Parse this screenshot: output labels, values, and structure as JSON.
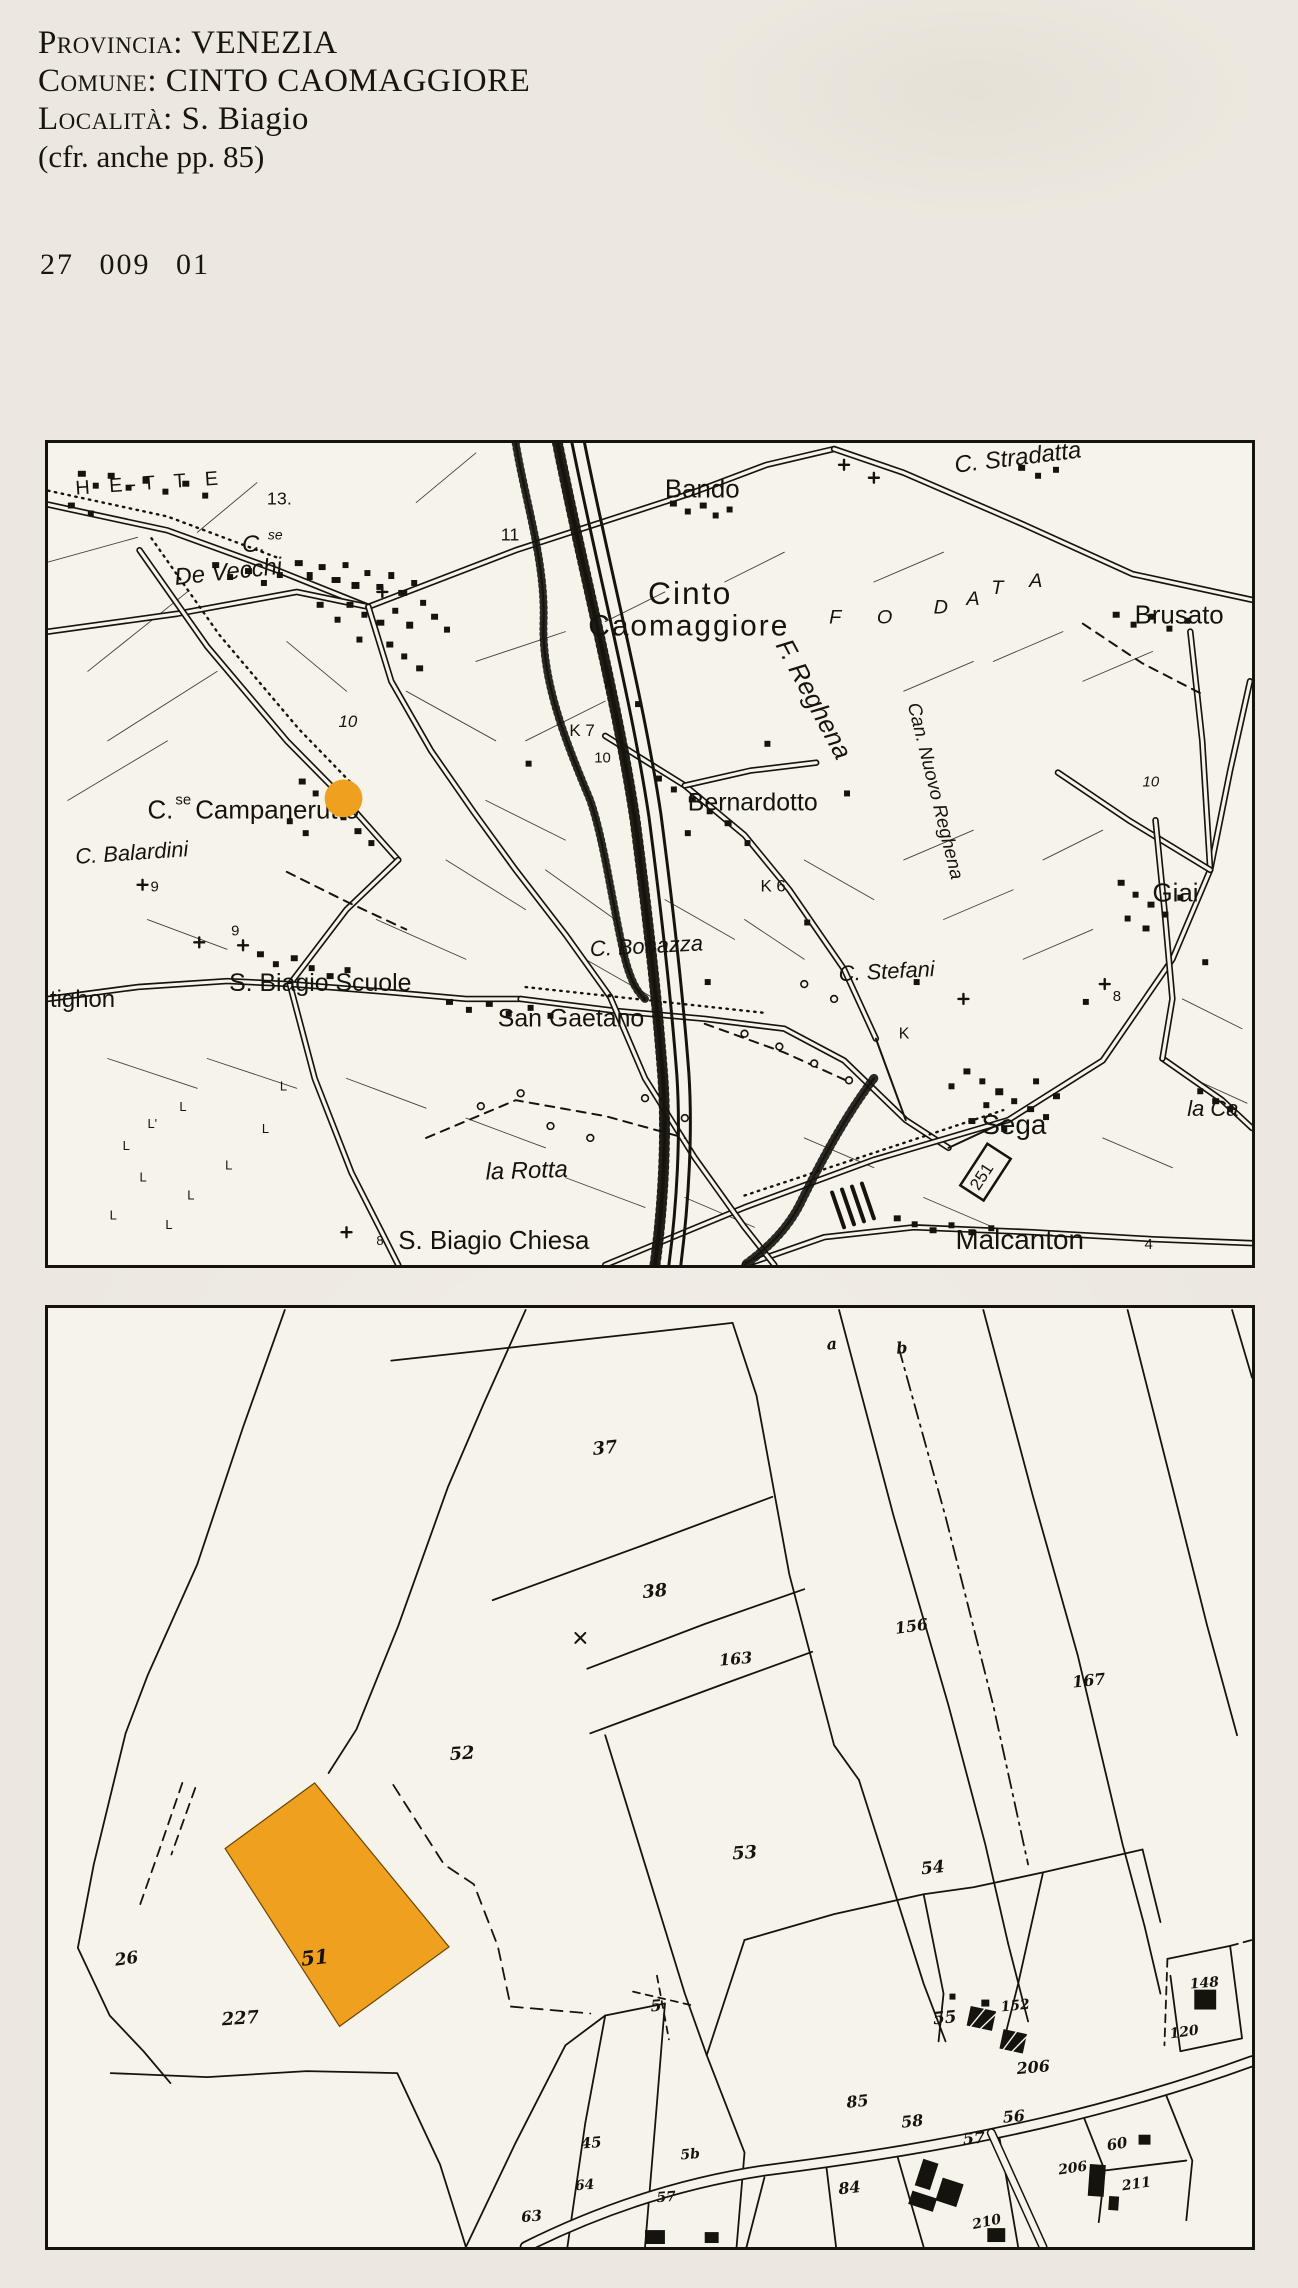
{
  "header": {
    "lines": [
      {
        "label": "Provincia:",
        "value": "VENEZIA"
      },
      {
        "label": "Comune:",
        "value": "CINTO CAOMAGGIORE"
      },
      {
        "label": "Località:",
        "value": "S. Biagio"
      }
    ],
    "note": "(cfr. anche pp. 85)",
    "code": "27 009 01"
  },
  "colors": {
    "paper": "#ece8df",
    "map_paper": "#f6f3ea",
    "ink": "#15130d",
    "highlight": "#f0a01f"
  },
  "map_top": {
    "marker": {
      "x": 297,
      "y": 358,
      "r": 19
    },
    "labels": [
      {
        "t": "H E-T T E",
        "x": 28,
        "y": 52,
        "fs": 20,
        "ls": 7,
        "rot": -4
      },
      {
        "t": "13.",
        "x": 220,
        "y": 62,
        "fs": 18
      },
      {
        "t": "C.",
        "x": 195,
        "y": 110,
        "fs": 24,
        "c": "it"
      },
      {
        "t": "se",
        "x": 221,
        "y": 97,
        "fs": 14,
        "c": "it"
      },
      {
        "t": "De Vecchi",
        "x": 128,
        "y": 143,
        "fs": 24,
        "c": "it",
        "rot": -6
      },
      {
        "t": "11",
        "x": 455,
        "y": 98,
        "fs": 18
      },
      {
        "t": "Bando",
        "x": 620,
        "y": 55,
        "fs": 26
      },
      {
        "t": "Cinto",
        "x": 603,
        "y": 162,
        "fs": 32,
        "ls": 2
      },
      {
        "t": "Caomaggiore",
        "x": 543,
        "y": 194,
        "fs": 30,
        "ls": 2
      },
      {
        "t": "C. Stradatta",
        "x": 912,
        "y": 30,
        "fs": 24,
        "c": "it",
        "rot": -7
      },
      {
        "t": "Brusato",
        "x": 1092,
        "y": 182,
        "fs": 26
      },
      {
        "t": "F",
        "x": 785,
        "y": 182,
        "fs": 20,
        "c": "it"
      },
      {
        "t": "O",
        "x": 833,
        "y": 182,
        "fs": 20,
        "c": "it"
      },
      {
        "t": "D",
        "x": 890,
        "y": 172,
        "fs": 20,
        "c": "it"
      },
      {
        "t": "A",
        "x": 923,
        "y": 163,
        "fs": 20,
        "c": "it"
      },
      {
        "t": "T",
        "x": 948,
        "y": 152,
        "fs": 20,
        "c": "it"
      },
      {
        "t": "A",
        "x": 986,
        "y": 145,
        "fs": 20,
        "c": "it"
      },
      {
        "t": "F. Reghena",
        "x": 762,
        "y": 262,
        "fs": 26,
        "c": "it",
        "rot": 62,
        "a": "m"
      },
      {
        "t": "Can. Nuovo Reghena",
        "x": 886,
        "y": 352,
        "fs": 19,
        "c": "it",
        "rot": 76,
        "a": "m"
      },
      {
        "t": "10",
        "x": 292,
        "y": 286,
        "fs": 17,
        "c": "it"
      },
      {
        "t": "C.",
        "x": 100,
        "y": 378,
        "fs": 26
      },
      {
        "t": "se",
        "x": 128,
        "y": 364,
        "fs": 15
      },
      {
        "t": "Campanerutto",
        "x": 148,
        "y": 378,
        "fs": 26
      },
      {
        "t": "C. Balardini",
        "x": 28,
        "y": 424,
        "fs": 22,
        "c": "it",
        "rot": -4
      },
      {
        "t": "9",
        "x": 103,
        "y": 452,
        "fs": 15
      },
      {
        "t": "K 7",
        "x": 524,
        "y": 295,
        "fs": 17
      },
      {
        "t": "10",
        "x": 549,
        "y": 322,
        "fs": 15
      },
      {
        "t": "Bernardotto",
        "x": 643,
        "y": 370,
        "fs": 25
      },
      {
        "t": "K 6",
        "x": 716,
        "y": 452,
        "fs": 17
      },
      {
        "t": "S. Biagio Scuole",
        "x": 182,
        "y": 552,
        "fs": 25
      },
      {
        "t": "tighon",
        "x": 2,
        "y": 568,
        "fs": 24
      },
      {
        "t": "9",
        "x": 184,
        "y": 496,
        "fs": 15
      },
      {
        "t": "San Gaetano",
        "x": 452,
        "y": 588,
        "fs": 25
      },
      {
        "t": "C. Bonazza",
        "x": 545,
        "y": 517,
        "fs": 22,
        "c": "it",
        "rot": -3
      },
      {
        "t": "C. Stefani",
        "x": 795,
        "y": 542,
        "fs": 22,
        "c": "it",
        "rot": -3
      },
      {
        "t": "K",
        "x": 855,
        "y": 600,
        "fs": 16
      },
      {
        "t": "Sega",
        "x": 938,
        "y": 696,
        "fs": 28
      },
      {
        "t": "251",
        "x": 943,
        "y": 742,
        "fs": 17,
        "rot": -57,
        "a": "m"
      },
      {
        "t": "Malcanton",
        "x": 912,
        "y": 812,
        "fs": 28
      },
      {
        "t": "la Ca",
        "x": 1145,
        "y": 678,
        "fs": 22,
        "c": "it"
      },
      {
        "t": "Giai",
        "x": 1110,
        "y": 462,
        "fs": 26
      },
      {
        "t": "10",
        "x": 1100,
        "y": 346,
        "fs": 15,
        "c": "it"
      },
      {
        "t": "8",
        "x": 1070,
        "y": 562,
        "fs": 15
      },
      {
        "t": "la Rotta",
        "x": 440,
        "y": 742,
        "fs": 24,
        "c": "it",
        "rot": -2
      },
      {
        "t": "S. Biagio Chiesa",
        "x": 352,
        "y": 812,
        "fs": 26
      },
      {
        "t": "8",
        "x": 330,
        "y": 808,
        "fs": 13
      },
      {
        "t": "4",
        "x": 1102,
        "y": 812,
        "fs": 15
      },
      {
        "t": "L",
        "x": 233,
        "y": 652,
        "fs": 13
      },
      {
        "t": "L",
        "x": 132,
        "y": 673,
        "fs": 13
      },
      {
        "t": "L'",
        "x": 100,
        "y": 690,
        "fs": 13
      },
      {
        "t": "L",
        "x": 215,
        "y": 695,
        "fs": 13
      },
      {
        "t": "L",
        "x": 75,
        "y": 712,
        "fs": 13
      },
      {
        "t": "L",
        "x": 178,
        "y": 732,
        "fs": 13
      },
      {
        "t": "L",
        "x": 92,
        "y": 744,
        "fs": 13
      },
      {
        "t": "L",
        "x": 140,
        "y": 762,
        "fs": 13
      },
      {
        "t": "L",
        "x": 62,
        "y": 782,
        "fs": 13
      },
      {
        "t": "L",
        "x": 118,
        "y": 792,
        "fs": 13
      }
    ]
  },
  "map_bottom": {
    "parcel": {
      "number": "51",
      "points": "268,478 403,643 293,723 178,544"
    },
    "labels": [
      {
        "t": "a",
        "x": 783,
        "y": 42,
        "fs": 16,
        "rot": -5
      },
      {
        "t": "b",
        "x": 853,
        "y": 46,
        "fs": 16,
        "rot": -5
      },
      {
        "t": "37",
        "x": 548,
        "y": 148,
        "fs": 18,
        "rot": -6
      },
      {
        "t": "38",
        "x": 598,
        "y": 292,
        "fs": 18,
        "rot": -6
      },
      {
        "t": "163",
        "x": 675,
        "y": 360,
        "fs": 16,
        "rot": -5
      },
      {
        "t": "156",
        "x": 852,
        "y": 328,
        "fs": 16,
        "rot": -8
      },
      {
        "t": "167",
        "x": 1030,
        "y": 382,
        "fs": 16,
        "rot": -6
      },
      {
        "t": "52",
        "x": 404,
        "y": 455,
        "fs": 18,
        "rot": -4
      },
      {
        "t": "53",
        "x": 688,
        "y": 555,
        "fs": 18,
        "rot": -4
      },
      {
        "t": "54",
        "x": 878,
        "y": 570,
        "fs": 17,
        "rot": -6
      },
      {
        "t": "26",
        "x": 68,
        "y": 662,
        "fs": 17,
        "rot": -8
      },
      {
        "t": "51",
        "x": 255,
        "y": 662,
        "fs": 20,
        "rot": -6
      },
      {
        "t": "227",
        "x": 175,
        "y": 722,
        "fs": 18,
        "rot": -4
      },
      {
        "t": "5",
        "x": 606,
        "y": 708,
        "fs": 16,
        "rot": -5
      },
      {
        "t": "55",
        "x": 890,
        "y": 721,
        "fs": 17,
        "rot": -6
      },
      {
        "t": "152",
        "x": 958,
        "y": 708,
        "fs": 14,
        "rot": -6
      },
      {
        "t": "206",
        "x": 974,
        "y": 771,
        "fs": 16,
        "rot": -5
      },
      {
        "t": "85",
        "x": 803,
        "y": 805,
        "fs": 16,
        "rot": -6
      },
      {
        "t": "58",
        "x": 858,
        "y": 825,
        "fs": 16,
        "rot": -6
      },
      {
        "t": "56",
        "x": 960,
        "y": 820,
        "fs": 16,
        "rot": -5
      },
      {
        "t": "57",
        "x": 920,
        "y": 842,
        "fs": 16,
        "rot": -5
      },
      {
        "t": "84",
        "x": 795,
        "y": 892,
        "fs": 16,
        "rot": -6
      },
      {
        "t": "60",
        "x": 1065,
        "y": 848,
        "fs": 15,
        "rot": -10
      },
      {
        "t": "206",
        "x": 1016,
        "y": 872,
        "fs": 14,
        "rot": -8
      },
      {
        "t": "211",
        "x": 1080,
        "y": 888,
        "fs": 14,
        "rot": -8
      },
      {
        "t": "210",
        "x": 930,
        "y": 927,
        "fs": 14,
        "rot": -12
      },
      {
        "t": "148",
        "x": 1148,
        "y": 685,
        "fs": 14,
        "rot": -5
      },
      {
        "t": "120",
        "x": 1128,
        "y": 735,
        "fs": 14,
        "rot": -8
      },
      {
        "t": "45",
        "x": 536,
        "y": 846,
        "fs": 15,
        "rot": -5
      },
      {
        "t": "5b",
        "x": 636,
        "y": 857,
        "fs": 14,
        "rot": -5
      },
      {
        "t": "57",
        "x": 612,
        "y": 900,
        "fs": 14,
        "rot": -5
      },
      {
        "t": "63",
        "x": 476,
        "y": 920,
        "fs": 15,
        "rot": -5
      },
      {
        "t": "64",
        "x": 530,
        "y": 888,
        "fs": 14,
        "rot": -5
      }
    ]
  }
}
